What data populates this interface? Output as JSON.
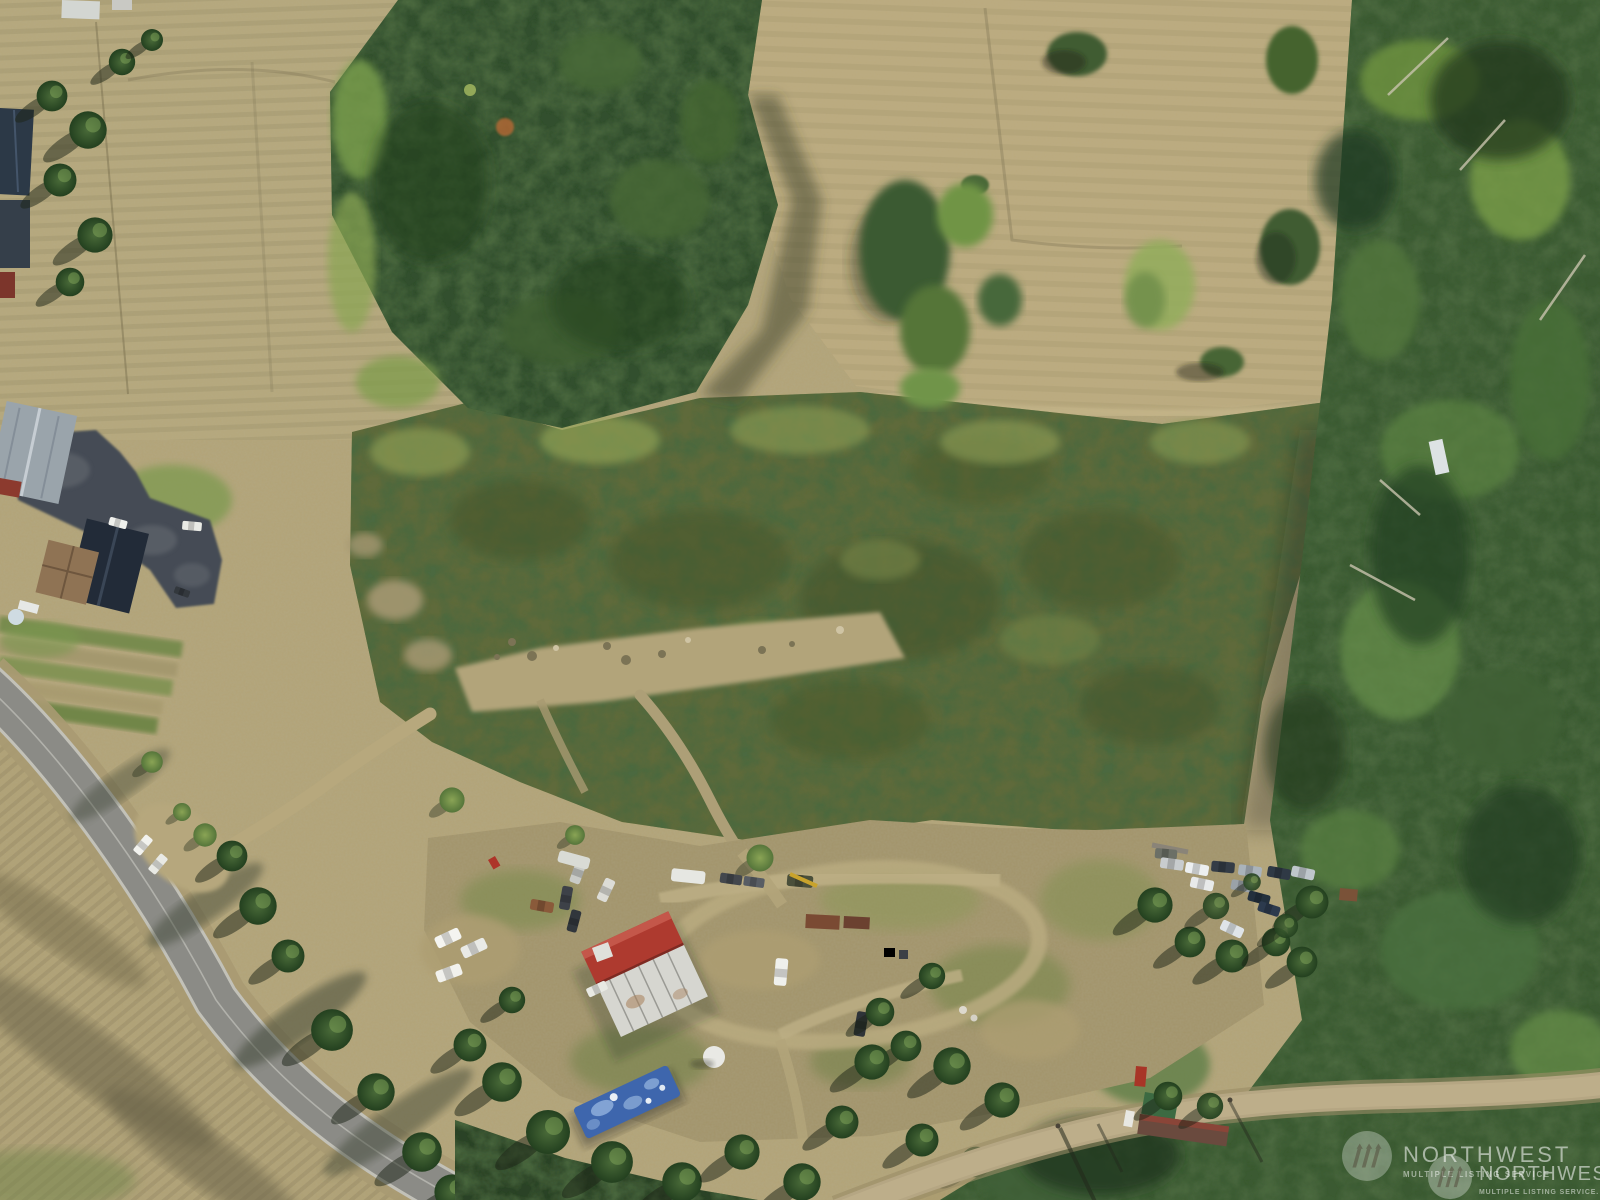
{
  "photo": {
    "kind": "aerial-drone-photo",
    "subject": "rural acreage with fields, scrubland, forest, country road and homestead clearing"
  },
  "watermark": {
    "back": {
      "title": "NORTHWEST",
      "subtitle": "MULTIPLE LISTING SERVICE"
    },
    "front": {
      "title": "NORTHWEST",
      "subtitle": "MULTIPLE LISTING SERVICE."
    },
    "logo": "nwmls-three-slash-evergreen-icon",
    "color": "#ffffff"
  },
  "palette": {
    "field_tan": "#b3a478",
    "field_light": "#bcab7e",
    "scrub_green": "#5f6b3a",
    "forest_dark": "#33502d",
    "forest_highlight": "#7ca04e",
    "road_pavement": "#8b8b86",
    "road_shoulder": "#a89a72",
    "dirt_path": "#b2a47a",
    "asphalt_driveway": "#454c55",
    "shed_roof_red": "#ae3a2f",
    "shed_roof_white": "#d6d6d0",
    "tarp_blue": "#3e66ad",
    "barn_roof_gray": "#9aa4ab",
    "house_roof_dark": "#222b38",
    "house_roof_brown": "#8f7354"
  }
}
